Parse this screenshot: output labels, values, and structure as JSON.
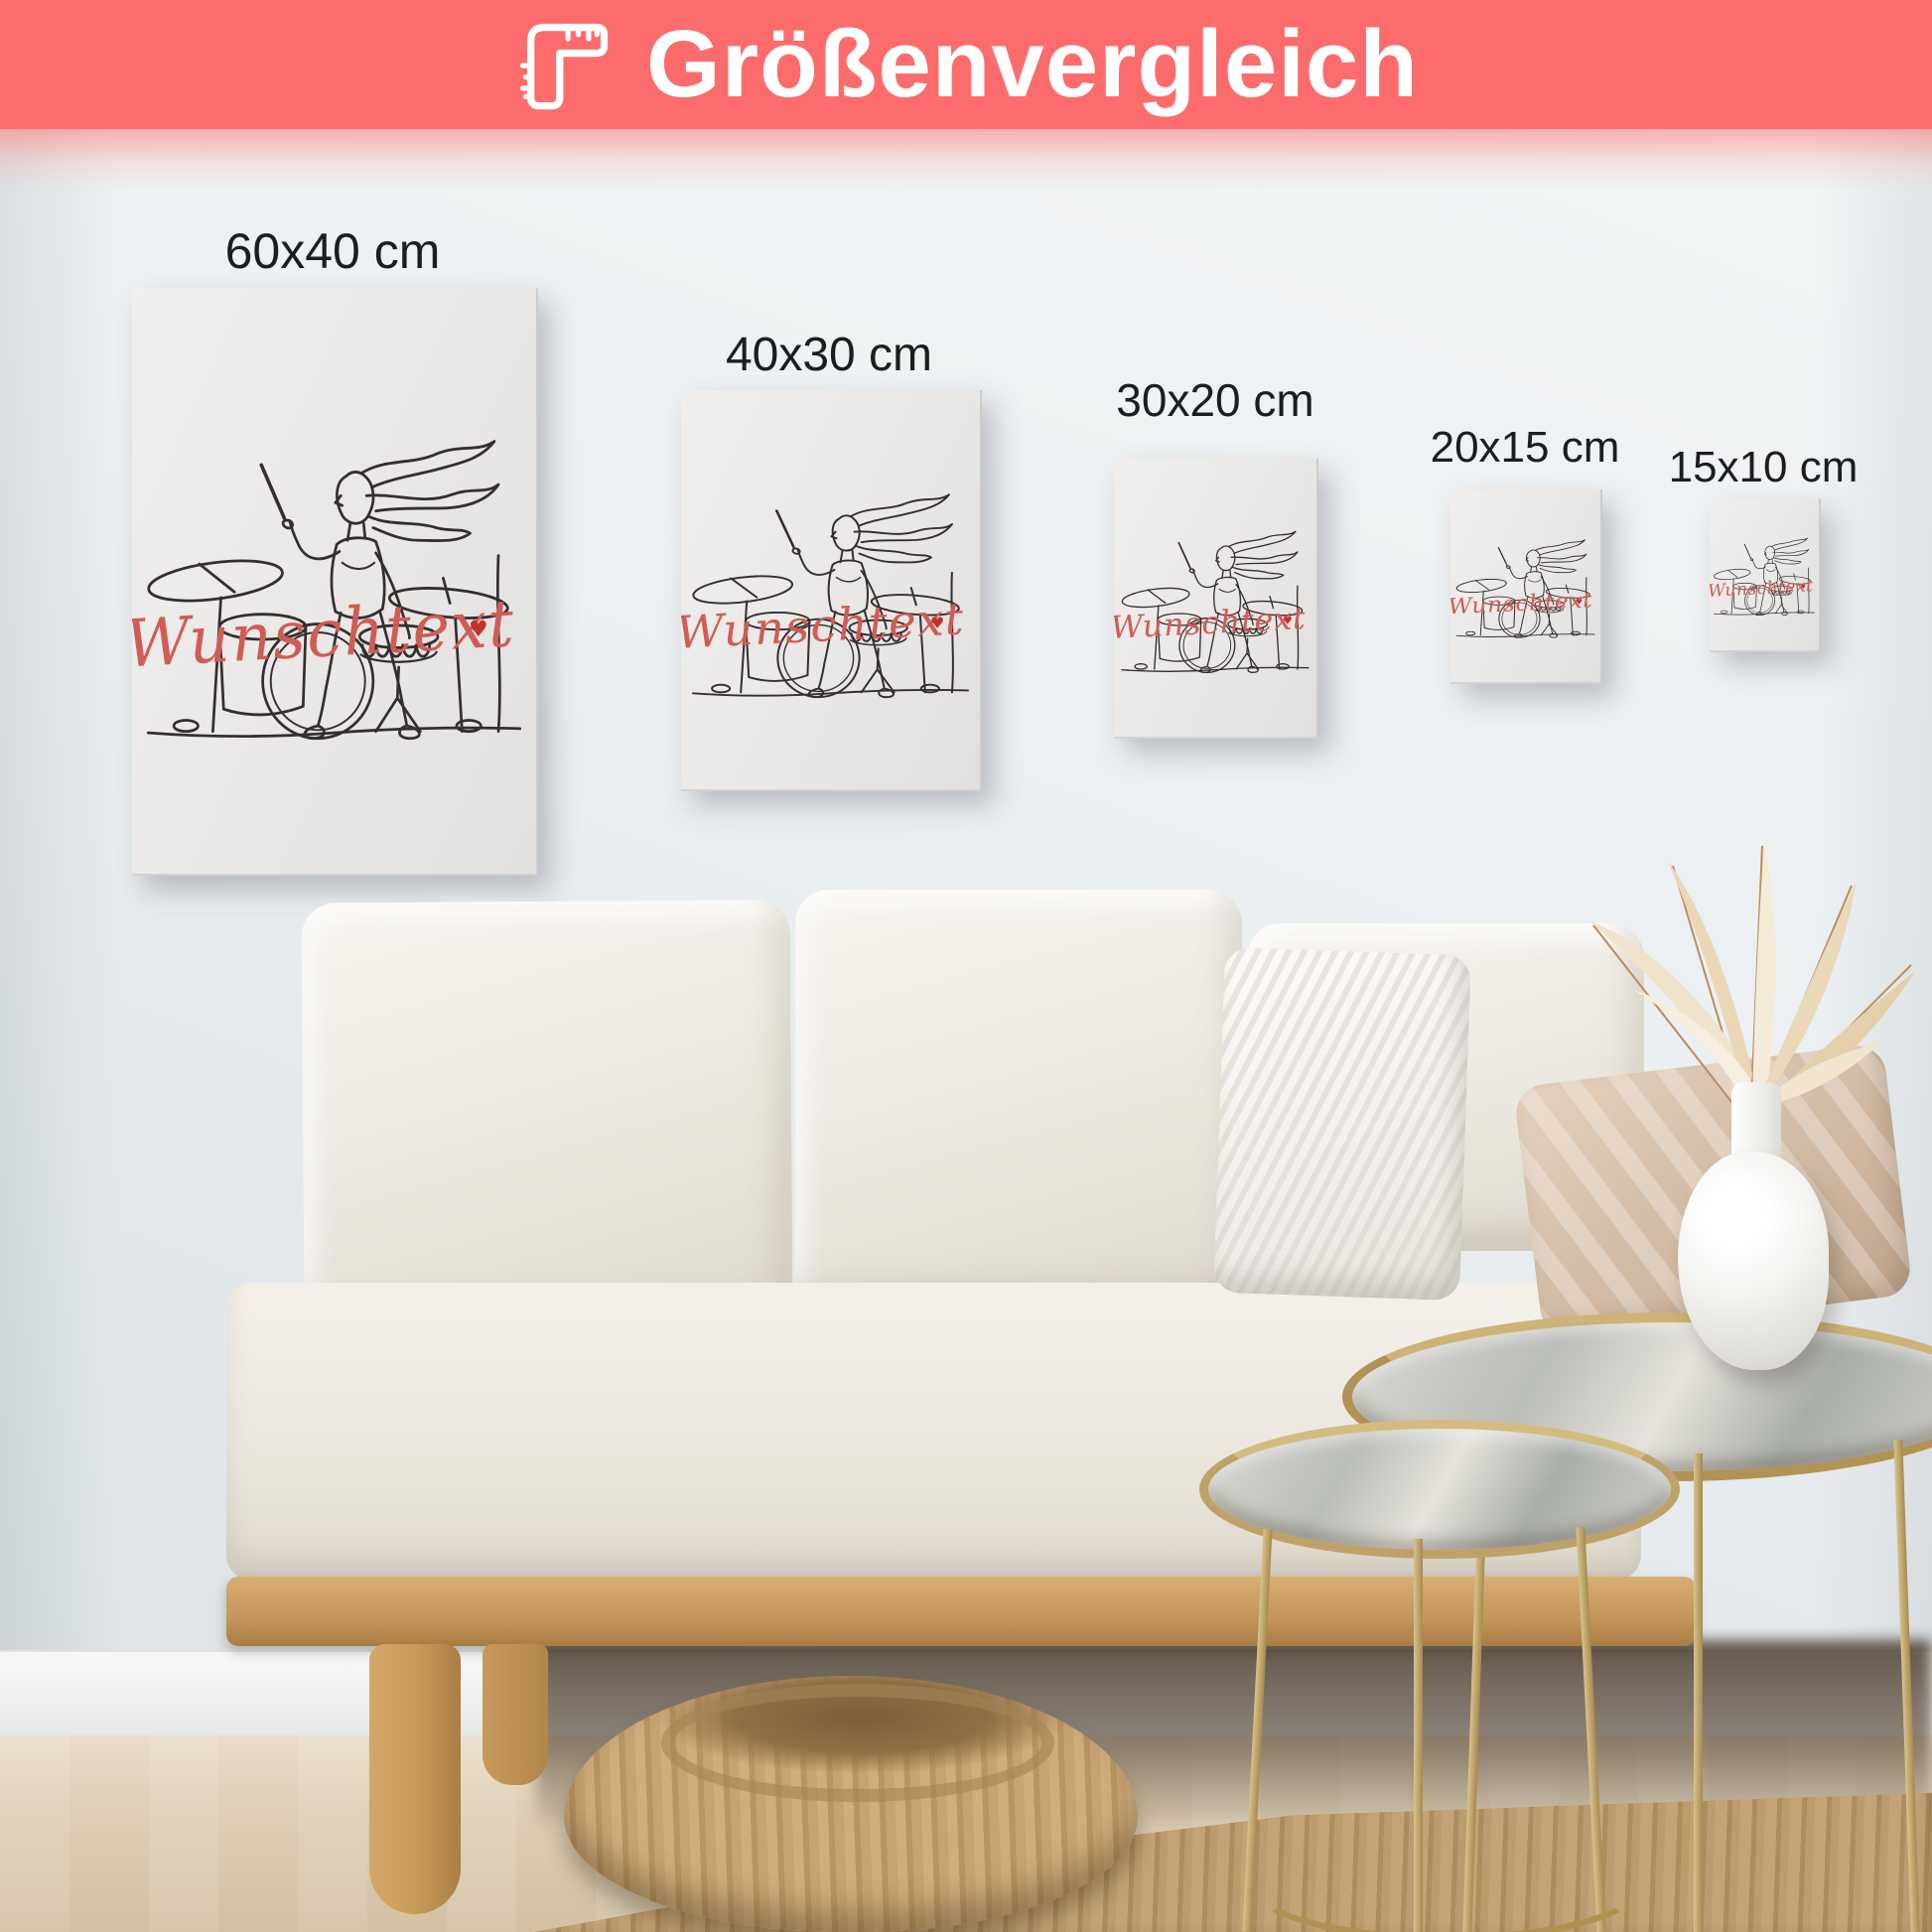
{
  "header": {
    "title": "Größenvergleich",
    "icon": "ruler-icon",
    "background_color": "#fd6c6c",
    "text_color": "#ffffff"
  },
  "sizes": [
    {
      "label": "60x40 cm"
    },
    {
      "label": "40x30 cm"
    },
    {
      "label": "30x20 cm"
    },
    {
      "label": "20x15 cm"
    },
    {
      "label": "15x10 cm"
    }
  ],
  "poster": {
    "subject": "one-line drawing of a woman playing a drum kit",
    "custom_text": "Wunschtext",
    "heart_symbol": "♥",
    "line_color": "#332f2f",
    "text_color": "#d05c55",
    "background_color": "#edecea"
  },
  "scene": {
    "wall_color": "#e9edef",
    "baseboard_color": "#f4f5f4",
    "floor_color": "#dccdb4",
    "sofa_fabric_color": "#efece4",
    "sofa_wood_color": "#c89a5c",
    "pouf_color": "#c3a06e",
    "rug_color": "#b5955f",
    "table_metal_color": "#b79b5e",
    "vase_color": "#f6f5f2",
    "knit_pillow_color": "#f7f6f3",
    "satin_pillow_color": "#d8c3ab",
    "dried_leaves_color": "#eedfc4"
  }
}
